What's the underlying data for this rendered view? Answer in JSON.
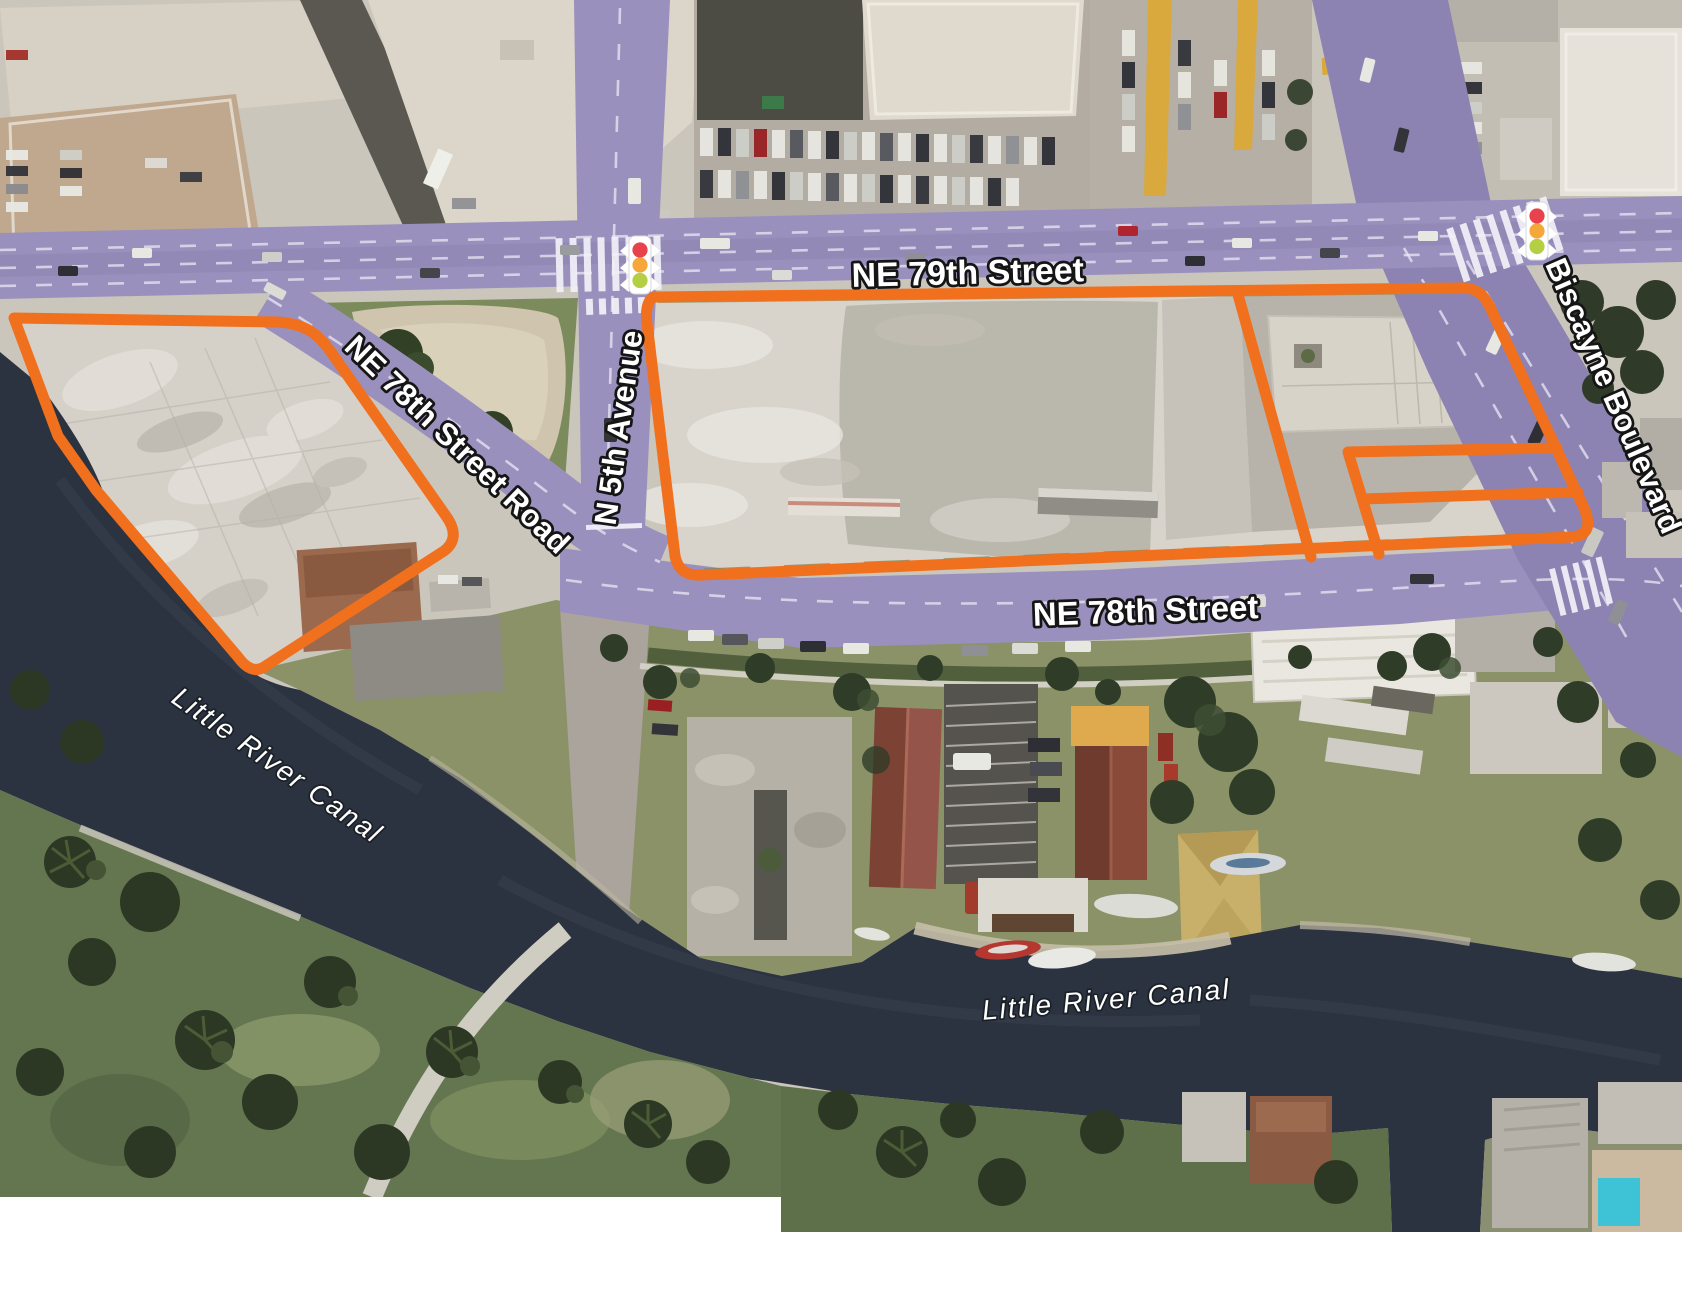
{
  "map": {
    "type": "aerial-site-plan",
    "streets": {
      "ne79": {
        "label": "NE 79th Street"
      },
      "biscayne": {
        "label": "Biscayne Boulevard"
      },
      "n5th": {
        "label": "N 5th Avenue"
      },
      "ne78road": {
        "label": "NE 78th Street Road"
      },
      "ne78": {
        "label": "NE 78th Street"
      }
    },
    "water": {
      "canal_west_label": "Little River Canal",
      "canal_east_label": "Little River Canal"
    },
    "icons": {
      "signal_west": "traffic-light-icon",
      "signal_east": "traffic-light-icon"
    },
    "colors": {
      "parcel_outline": "#f0701d",
      "road_highlight": "#9a90bd",
      "road_highlight_dark": "#8d83b2",
      "water": "#2b3240",
      "signal_red": "#e8434d",
      "signal_amber": "#f5a73c",
      "signal_green": "#b4cf44",
      "margin": "#ffffff"
    }
  }
}
